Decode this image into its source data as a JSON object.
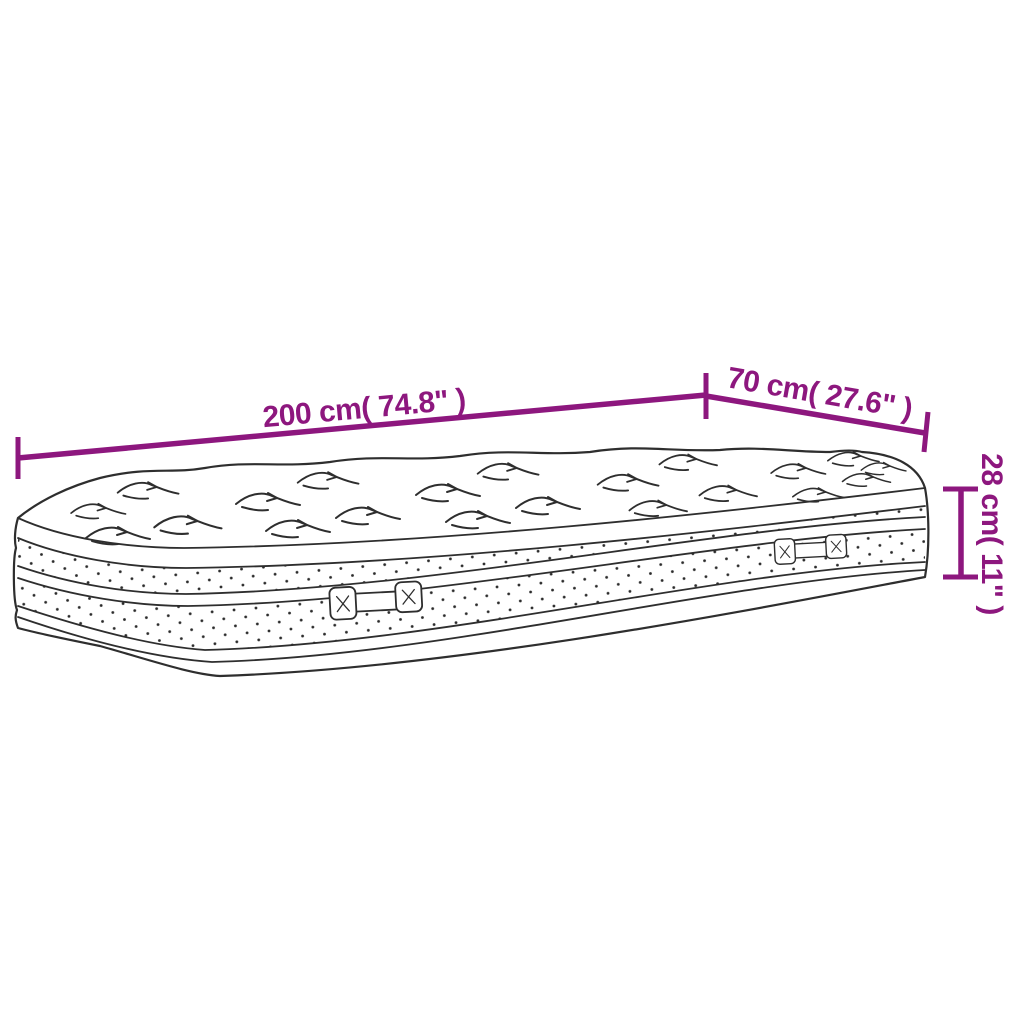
{
  "diagram": {
    "type": "product-dimension-diagram",
    "subject": "mattress",
    "labels": {
      "length": "200 cm( 74.8\" )",
      "width": "70 cm( 27.6\" )",
      "height": "28 cm( 11\" )"
    },
    "measurements": {
      "length_cm": 200,
      "length_in": 74.8,
      "width_cm": 70,
      "width_in": 27.6,
      "height_cm": 28,
      "height_in": 11
    },
    "colors": {
      "dimension_accent": "#8D177E",
      "line_art": "#2e2e2e",
      "background": "#FFFFFF"
    }
  }
}
